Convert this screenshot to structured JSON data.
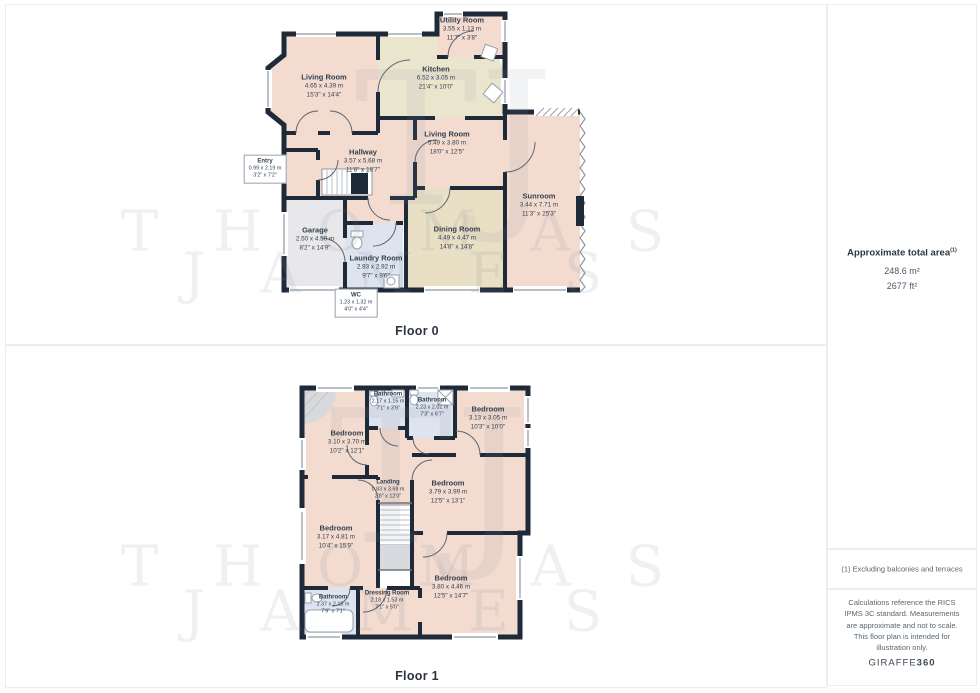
{
  "sidebar": {
    "total_area": {
      "label": "Approximate total area",
      "superscript": "(1)",
      "metric": "248.6 m²",
      "imperial": "2677 ft²"
    },
    "footnote": "(1) Excluding balconies and terraces",
    "disclaimer": "Calculations reference the RICS IPMS 3C standard. Measurements are approximate and not to scale. This floor plan is intended for illustration only.",
    "brand": {
      "name": "GIRAFFE",
      "suffix": "360"
    }
  },
  "watermark": {
    "monogram": "TJ",
    "line1": "THOMAS",
    "line2": "JAMES"
  },
  "floor0": {
    "label": "Floor 0",
    "rooms": [
      {
        "name": "Utility Room",
        "metric": "3.55 x 1.13 m",
        "imperial": "11'7\" x 3'8\""
      },
      {
        "name": "Living Room",
        "metric": "4.65 x 4.39 m",
        "imperial": "15'3\" x 14'4\""
      },
      {
        "name": "Kitchen",
        "metric": "6.52 x 3.05 m",
        "imperial": "21'4\" x 10'0\""
      },
      {
        "name": "Living Room",
        "metric": "5.49 x 3.80 m",
        "imperial": "18'0\" x 12'5\""
      },
      {
        "name": "Hallway",
        "metric": "3.57 x 5.68 m",
        "imperial": "11'8\" x 18'7\""
      },
      {
        "name": "Entry",
        "metric": "0.99 x 2.19 m",
        "imperial": "3'2\" x 7'2\""
      },
      {
        "name": "Sunroom",
        "metric": "3.44 x 7.71 m",
        "imperial": "11'3\" x 25'3\""
      },
      {
        "name": "Garage",
        "metric": "2.50 x 4.50 m",
        "imperial": "8'2\" x 14'9\""
      },
      {
        "name": "Dining Room",
        "metric": "4.49 x 4.47 m",
        "imperial": "14'8\" x 14'8\""
      },
      {
        "name": "Laundry Room",
        "metric": "2.93 x 2.92 m",
        "imperial": "9'7\" x 9'6\""
      },
      {
        "name": "WC",
        "metric": "1.23 x 1.32 m",
        "imperial": "4'0\" x 4'4\""
      }
    ]
  },
  "floor1": {
    "label": "Floor 1",
    "rooms": [
      {
        "name": "Bathroom",
        "metric": "2.17 x 1.15 m",
        "imperial": "7'1\" x 3'9\""
      },
      {
        "name": "Bathroom",
        "metric": "2.23 x 2.02 m",
        "imperial": "7'3\" x 6'7\""
      },
      {
        "name": "Bedroom",
        "metric": "3.13 x 3.05 m",
        "imperial": "10'3\" x 10'0\""
      },
      {
        "name": "Bedroom",
        "metric": "3.10 x 3.70 m",
        "imperial": "10'2\" x 12'1\""
      },
      {
        "name": "Landing",
        "metric": "0.83 x 3.68 m",
        "imperial": "2'8\" x 12'0\""
      },
      {
        "name": "Bedroom",
        "metric": "3.79 x 3.99 m",
        "imperial": "12'5\" x 13'1\""
      },
      {
        "name": "Bedroom",
        "metric": "3.17 x 4.81 m",
        "imperial": "10'4\" x 15'9\""
      },
      {
        "name": "Bedroom",
        "metric": "3.80 x 4.46 m",
        "imperial": "12'5\" x 14'7\""
      },
      {
        "name": "Dressing Room",
        "metric": "2.18 x 1.53 m",
        "imperial": "7'1\" x 5'0\""
      },
      {
        "name": "Bathroom",
        "metric": "2.37 x 2.18 m",
        "imperial": "7'9\" x 7'1\""
      }
    ]
  },
  "colors": {
    "wall": "#1f2a39",
    "room_pink": "#f3dbd0",
    "room_khaki": "#eae6ce",
    "room_tan": "#e9dfc5",
    "room_gray": "#e8e8ea",
    "room_blue": "#dde4ef",
    "stair_gray": "#d8dae0",
    "label_text": "#333f4d"
  }
}
